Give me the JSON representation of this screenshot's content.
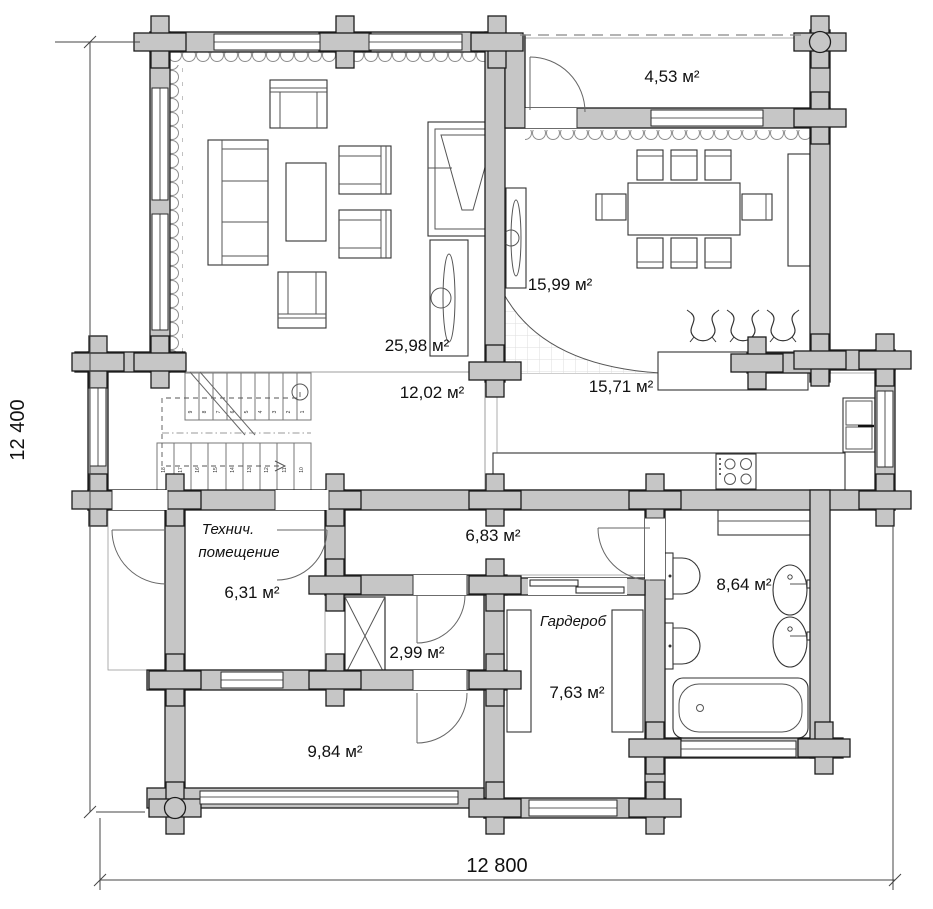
{
  "dimensions": {
    "left": "12 400",
    "bottom": "12 800"
  },
  "rooms": {
    "porch": {
      "area": "4,53 м²"
    },
    "living": {
      "area": "25,98 м²"
    },
    "dining": {
      "area": "15,99 м²"
    },
    "hall": {
      "area": "12,02 м²"
    },
    "kitchen": {
      "area": "15,71 м²"
    },
    "corridor": {
      "area": "6,83 м²"
    },
    "tech": {
      "name1": "Технич.",
      "name2": "помещение",
      "area": "6,31 м²"
    },
    "closet": {
      "area": "2,99 м²"
    },
    "wardrobe": {
      "name": "Гардероб",
      "area": "7,63 м²"
    },
    "bath": {
      "area": "8,64 м²"
    },
    "bedroom": {
      "area": "9,84 м²"
    }
  },
  "stairs": {
    "numbers": [
      "1",
      "2",
      "3",
      "4",
      "5",
      "6",
      "7",
      "8",
      "9",
      "10",
      "11",
      "12",
      "13",
      "14",
      "15",
      "16",
      "17",
      "18"
    ]
  },
  "colors": {
    "wall_fill": "#c6c6c6",
    "wall_stroke": "#1c1c1c",
    "floor_line": "#dcdcdc",
    "fixture_stroke": "#333333",
    "text": "#111111"
  }
}
